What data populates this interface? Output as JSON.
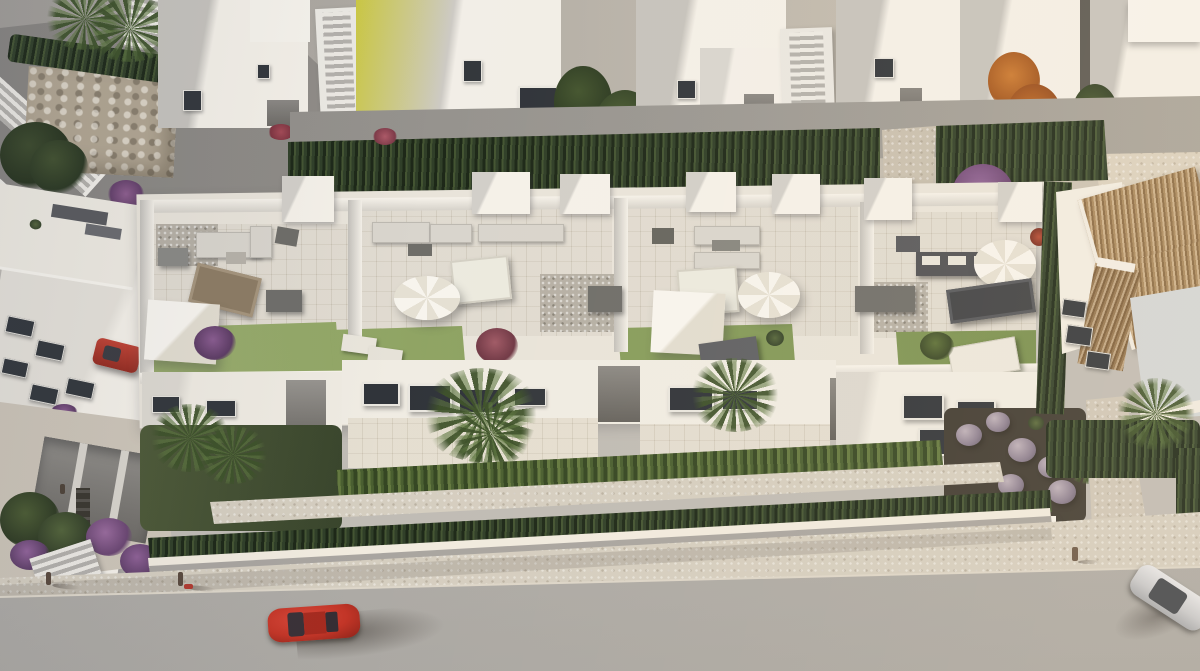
{
  "scene": {
    "label": "Aerial 3D architectural rendering of a modern white residential complex with rooftop terraces, gardens, palm trees and a street with cars",
    "view": "top-down aerial, warm low sunlight from the right, long shadows to the left",
    "text_present": false
  },
  "palette": {
    "white_lit": "#f5f1e9",
    "white_shade": "#c9c5bf",
    "terrace_floor": "#d8d1c3",
    "lawn_green": "#7d9750",
    "hedge_green": "#31402a",
    "sunlit_hedge": "#4c6132",
    "street_gray": "#b7b3af",
    "sidewalk_beige": "#d5cec0",
    "stone_wall": "#b2a692",
    "terracotta_roof": "#a8875c",
    "red_car": "#c23527",
    "silver_car": "#d6d7d9",
    "orange_tree": "#b86427",
    "purple_shrub": "#8e5f93",
    "window_dark": "#30343a",
    "soil_dark": "#3f3a32"
  },
  "objects": {
    "background_row": "row of white townhouses with external staircases and dark windows",
    "hedge_row": "tall cypress hedge separating rear gardens",
    "orange_tree": "orange autumn tree between rear buildings",
    "purple_tree": "purple flowering tree near right lane",
    "stone_wall": "stone retaining wall with hedge, top-left",
    "white_stairs": "white outdoor staircases descending top-left",
    "left_building": "angled white apartment block with roof furniture and parked red car",
    "main_complex": "new-build block of four rooftop terraces over street-facing duplexes",
    "terrace_furniture": "outdoor sofas, dining tables, round white parasols, square shade sails, sun loungers on lawns",
    "gravel_balls": "round clipped grey-violet shrubs in side garden",
    "front_hedge": "sunlit hedge above low white boundary wall",
    "villa_right": "villa with terracotta tiled roofs at right edge",
    "street": "asphalt street with red car driving and silver car at right edge",
    "pedestrians": "three tiny pedestrians on the sidewalk"
  },
  "counts": {
    "rooftop_terraces": 4,
    "round_parasols": 3,
    "shade_sails": 2,
    "street_cars": 2,
    "parked_cars": 1,
    "pedestrians": 3
  }
}
